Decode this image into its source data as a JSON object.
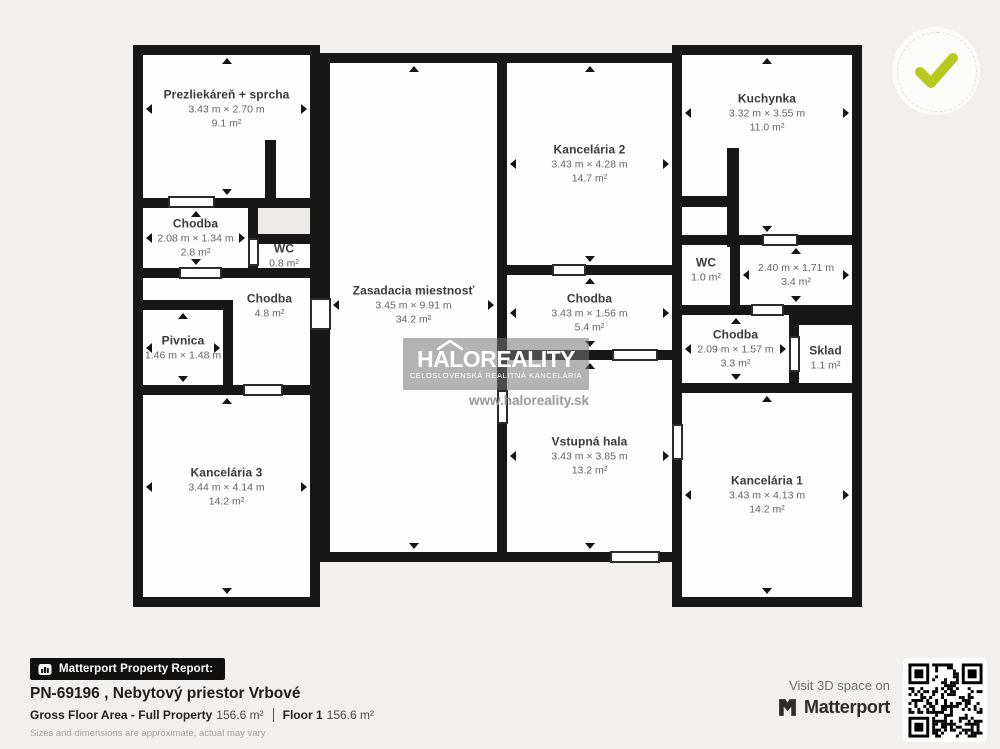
{
  "watermark": {
    "brand": "HALOREALITY",
    "subtitle": "CELOSLOVENSKÁ REALITNÁ KANCELÁRIA",
    "url": "www.haloreality.sk"
  },
  "badge": {
    "check_color": "#b6c91d"
  },
  "footer": {
    "report_label": "Matterport Property Report:",
    "property_title": "PN-69196 , Nebytový priestor Vrbové",
    "gross_label": "Gross Floor Area - Full Property",
    "gross_value": "156.6 m²",
    "floor_label": "Floor 1",
    "floor_value": "156.6 m²",
    "disclaimer": "Sizes and dimensions are approximate, actual may vary"
  },
  "visit": {
    "label": "Visit 3D space on",
    "brand": "Matterport"
  },
  "plan": {
    "wall_color": "#171717",
    "room_fill": "#fdfdfd",
    "rooms": [
      {
        "id": "prezliekaren",
        "name": "Prezliekáreň + sprcha",
        "dims": "3.43 m × 2.70 m",
        "area": "9.1 m²",
        "x": 133,
        "y": 45,
        "w": 187,
        "h": 163,
        "cy": 0.39,
        "arrows": true
      },
      {
        "id": "chodba-horna",
        "name": "Chodba",
        "dims": "2.08 m × 1.34 m",
        "area": "2.8 m²",
        "x": 133,
        "y": 198,
        "w": 125,
        "h": 80,
        "arrows": true
      },
      {
        "id": "nika",
        "x": 248,
        "y": 198,
        "w": 72,
        "h": 46,
        "fill": "#eceae7"
      },
      {
        "id": "wc-lavy",
        "name": "WC",
        "area": "0.8 m²",
        "x": 248,
        "y": 234,
        "w": 72,
        "h": 44
      },
      {
        "id": "chodba-stredna",
        "name": "Chodba",
        "area": "4.8 m²",
        "x": 133,
        "y": 268,
        "w": 187,
        "h": 127,
        "cx": 0.73,
        "cy": 0.3
      },
      {
        "id": "pivnica",
        "name": "Pivnica",
        "dims": "1.46 m × 1.48 m",
        "x": 133,
        "y": 300,
        "w": 100,
        "h": 95,
        "arrows": true
      },
      {
        "id": "kancelaria-3",
        "name": "Kancelária 3",
        "dims": "3.44 m × 4.14 m",
        "area": "14.2 m²",
        "x": 133,
        "y": 385,
        "w": 187,
        "h": 222,
        "cy": 0.46,
        "arrows": true
      },
      {
        "id": "zasadacia-miestnost",
        "name": "Zasadacia miestnosť",
        "dims": "3.45 m × 9.91 m",
        "area": "34.2 m²",
        "x": 320,
        "y": 53,
        "w": 187,
        "h": 509,
        "cy": 0.495,
        "arrows": true
      },
      {
        "id": "kancelaria-2",
        "name": "Kancelária 2",
        "dims": "3.43 m × 4.28 m",
        "area": "14.7 m²",
        "x": 497,
        "y": 53,
        "w": 185,
        "h": 222,
        "arrows": true
      },
      {
        "id": "chodba-prava",
        "name": "Chodba",
        "dims": "3.43 m × 1.56 m",
        "area": "5.4 m²",
        "x": 497,
        "y": 265,
        "w": 185,
        "h": 95,
        "arrows": true
      },
      {
        "id": "vstupna-hala",
        "name": "Vstupná hala",
        "dims": "3.43 m × 3.85 m",
        "area": "13.2 m²",
        "x": 497,
        "y": 350,
        "w": 185,
        "h": 212,
        "arrows": true
      },
      {
        "id": "kuchynka",
        "name": "Kuchynka",
        "dims": "3.32 m × 3.55 m",
        "area": "11.0 m²",
        "x": 672,
        "y": 45,
        "w": 190,
        "h": 200,
        "cy": 0.34,
        "arrows": true
      },
      {
        "id": "wc-pravy",
        "name": "WC",
        "area": "1.0 m²",
        "x": 672,
        "y": 235,
        "w": 68,
        "h": 80,
        "cy": 0.44
      },
      {
        "id": "miestnost-240",
        "dims": "2.40 m × 1.71 m",
        "area": "3.4 m²",
        "x": 730,
        "y": 235,
        "w": 132,
        "h": 80,
        "arrows": true
      },
      {
        "id": "chodba-dolna",
        "name": "Chodba",
        "dims": "2.09 m × 1.57 m",
        "area": "3.3 m²",
        "x": 672,
        "y": 305,
        "w": 127,
        "h": 88,
        "arrows": true
      },
      {
        "id": "sklad",
        "name": "Sklad",
        "area": "1.1 m²",
        "x": 789,
        "y": 315,
        "w": 73,
        "h": 78,
        "cy": 0.55
      },
      {
        "id": "kancelaria-1",
        "name": "Kancelária 1",
        "dims": "3.43 m × 4.13 m",
        "area": "14.2 m²",
        "x": 672,
        "y": 383,
        "w": 190,
        "h": 224,
        "arrows": true
      }
    ],
    "stubs": [
      {
        "x": 265,
        "y": 140,
        "w": 11,
        "h": 60
      },
      {
        "x": 727,
        "y": 148,
        "w": 12,
        "h": 99
      },
      {
        "x": 682,
        "y": 196,
        "w": 46,
        "h": 11
      }
    ],
    "doors": [
      {
        "x": 168,
        "y": 196,
        "w": 47,
        "h": 12
      },
      {
        "x": 179,
        "y": 267,
        "w": 43,
        "h": 12
      },
      {
        "x": 243,
        "y": 384,
        "w": 40,
        "h": 12
      },
      {
        "x": 610,
        "y": 551,
        "w": 50,
        "h": 12
      },
      {
        "x": 762,
        "y": 234,
        "w": 36,
        "h": 12
      },
      {
        "x": 751,
        "y": 304,
        "w": 33,
        "h": 12
      },
      {
        "x": 789,
        "y": 336,
        "w": 11,
        "h": 36
      },
      {
        "x": 248,
        "y": 238,
        "w": 11,
        "h": 28
      },
      {
        "x": 310,
        "y": 298,
        "w": 21,
        "h": 32
      },
      {
        "x": 497,
        "y": 390,
        "w": 11,
        "h": 34
      },
      {
        "x": 672,
        "y": 424,
        "w": 11,
        "h": 36
      },
      {
        "x": 612,
        "y": 349,
        "w": 46,
        "h": 12
      },
      {
        "x": 552,
        "y": 264,
        "w": 34,
        "h": 12
      }
    ]
  }
}
